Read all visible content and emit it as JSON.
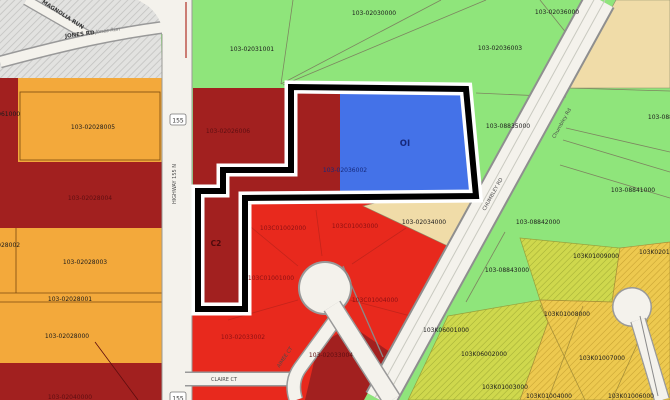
{
  "map": {
    "colors": {
      "parcel_green": "#8FE57B",
      "parcel_orange": "#F3A93B",
      "parcel_dark_red": "#A2201F",
      "parcel_red": "#E8291D",
      "parcel_blue": "#4472E8",
      "parcel_tan": "#F0DCA8",
      "hatch_gold": "#EDC94F",
      "hatch_olive": "#CFD84D",
      "hatch_gray": "#E2E2E0",
      "road_fill": "#F4F2EC",
      "selection_outline": "#000000"
    }
  },
  "parcels": [
    {
      "id": "p31001",
      "label": "103-02031001"
    },
    {
      "id": "p30000",
      "label": "103-02030000"
    },
    {
      "id": "p36000",
      "label": "103-02036000"
    },
    {
      "id": "p36003",
      "label": "103-02036003"
    },
    {
      "id": "p35000",
      "label": "103-08835000"
    },
    {
      "id": "p08840",
      "label": "103-08840000"
    },
    {
      "id": "p08841",
      "label": "103-08841000"
    },
    {
      "id": "p08842",
      "label": "103-08842000"
    },
    {
      "id": "p08843",
      "label": "103-08843000"
    },
    {
      "id": "p61000",
      "label": "103-02061000"
    },
    {
      "id": "p28005",
      "label": "103-02028005"
    },
    {
      "id": "p28004",
      "label": "103-02028004"
    },
    {
      "id": "p28003",
      "label": "103-02028003"
    },
    {
      "id": "p28002",
      "label": "103-02028002"
    },
    {
      "id": "p28001",
      "label": "103-02028001"
    },
    {
      "id": "p28000",
      "label": "103-02028000"
    },
    {
      "id": "p40000",
      "label": "103-02040000"
    },
    {
      "id": "p26006",
      "label": "103-02026006"
    },
    {
      "id": "zoneC2",
      "label": "C2"
    },
    {
      "id": "zoneOI",
      "label": "OI"
    },
    {
      "id": "p36002",
      "label": "103-02036002"
    },
    {
      "id": "p34000",
      "label": "103-02034000"
    },
    {
      "id": "c01002",
      "label": "103C01002000"
    },
    {
      "id": "c01003",
      "label": "103C01003000"
    },
    {
      "id": "c01001",
      "label": "103C01001000"
    },
    {
      "id": "c01004",
      "label": "103C01004000"
    },
    {
      "id": "p33002",
      "label": "103-02033002"
    },
    {
      "id": "p33004",
      "label": "103-02033004"
    },
    {
      "id": "k01009",
      "label": "103K01009000"
    },
    {
      "id": "k02010",
      "label": "103K02010000"
    },
    {
      "id": "k06001",
      "label": "103K06001000"
    },
    {
      "id": "k06002",
      "label": "103K06002000"
    },
    {
      "id": "k01003",
      "label": "103K01003000"
    },
    {
      "id": "k01008",
      "label": "103K01008000"
    },
    {
      "id": "k01007",
      "label": "103K01007000"
    },
    {
      "id": "k01004",
      "label": "103K01004000"
    },
    {
      "id": "k01006",
      "label": "103K01006000"
    }
  ],
  "roads": {
    "highway_shield": "155",
    "highway": "HIGHWAY 155 N",
    "jones": "JONES RD",
    "jones_run": "Jones Run",
    "magnolia": "MAGNOLIA RUN",
    "chumbley_mixed": "Chumbley Rd",
    "chumbley_upper": "CHUMBLEY RD",
    "claire": "CLAIRE CT",
    "aimee": "AIMEE CT"
  }
}
